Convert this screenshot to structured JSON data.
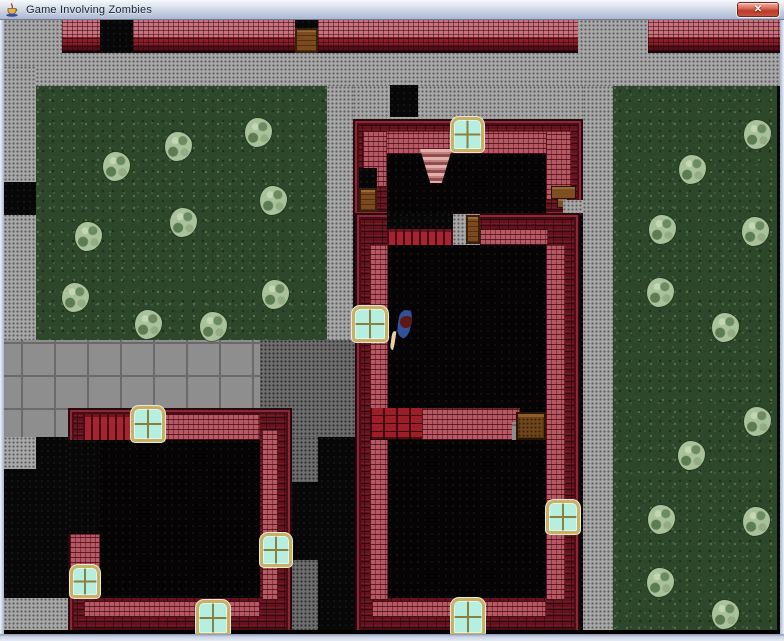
{
  "window": {
    "title": "Game Involving Zombies",
    "close_label": "✕"
  },
  "icons": {
    "app_icon": "java-coffee-cup-icon",
    "close_icon": "close-icon"
  },
  "palette": {
    "titlebar_top": "#f6f8fc",
    "titlebar_bottom": "#acb8cf",
    "frame": "#ccd4e6",
    "grass": "#2c472a",
    "bush": "#a9c29b",
    "pavement": "#a8a8a8",
    "pavement_dark": "#6e6e6e",
    "sidewalk": "#8e8e8e",
    "brick_dark": "#64121d",
    "brick_pink": "#b55a64",
    "brick_bright": "#9c1e29",
    "window_pane": "#b6efe0",
    "window_frame": "#c7b264",
    "door": "#7c4a1d",
    "chest": "#6f4519",
    "interior": "#040404",
    "player_body": "#31519b",
    "player_head": "#5e1717",
    "player_hand": "#eccfa6"
  },
  "scene": {
    "viewport": {
      "x": 4,
      "y": 20,
      "width": 776,
      "height": 614
    },
    "legend": {
      "plaza": "light dotted pavement",
      "darkplaza": "dark dotted pavement",
      "sidewalk": "gray sidewalk tiles",
      "grass": "grass lawn",
      "black": "unexplored void",
      "blackpure": "bottom black strip",
      "interior": "building interior floor",
      "wall": "dark red brick wall",
      "walltop": "street-top brick wall with pink course",
      "wallpink": "pink inner wall face",
      "redbrick": "bright red brick partition",
      "planks": "red plank wall",
      "window": "cyan window",
      "door": "wooden door",
      "chest": "wooden chest",
      "shelf": "wooden shelf",
      "stairs": "pink staircase"
    },
    "layers": [
      {
        "t": "black",
        "r": [
          0,
          0,
          776,
          614
        ]
      },
      {
        "t": "plaza",
        "r": [
          0,
          0,
          776,
          66
        ]
      },
      {
        "t": "plaza",
        "r": [
          0,
          46,
          32,
          274
        ]
      },
      {
        "t": "black",
        "r": [
          0,
          162,
          32,
          33
        ]
      },
      {
        "t": "grass",
        "r": [
          32,
          66,
          291,
          287
        ]
      },
      {
        "t": "plaza",
        "r": [
          323,
          66,
          26,
          254
        ]
      },
      {
        "t": "plaza",
        "r": [
          349,
          66,
          230,
          33
        ]
      },
      {
        "t": "plaza",
        "r": [
          579,
          66,
          30,
          548
        ]
      },
      {
        "t": "grass",
        "r": [
          609,
          66,
          164,
          544
        ]
      },
      {
        "t": "sidewalk",
        "r": [
          0,
          320,
          256,
          100
        ]
      },
      {
        "t": "darkplaza",
        "r": [
          256,
          320,
          100,
          97
        ]
      },
      {
        "t": "black",
        "r": [
          256,
          417,
          100,
          197
        ]
      },
      {
        "t": "darkplaza",
        "r": [
          288,
          417,
          26,
          45
        ]
      },
      {
        "t": "darkplaza",
        "r": [
          288,
          540,
          26,
          70
        ]
      },
      {
        "t": "black",
        "r": [
          0,
          417,
          64,
          197
        ]
      },
      {
        "t": "plaza",
        "r": [
          0,
          417,
          32,
          32
        ]
      },
      {
        "t": "plaza",
        "r": [
          0,
          578,
          64,
          34
        ]
      },
      {
        "t": "walltop",
        "r": [
          58,
          0,
          38,
          33
        ]
      },
      {
        "t": "black",
        "r": [
          96,
          0,
          33,
          33
        ]
      },
      {
        "t": "walltop",
        "r": [
          129,
          0,
          162,
          33
        ]
      },
      {
        "t": "black",
        "r": [
          291,
          0,
          23,
          10
        ]
      },
      {
        "t": "door",
        "r": [
          291,
          8,
          23,
          25
        ]
      },
      {
        "t": "walltop",
        "r": [
          314,
          0,
          260,
          33
        ]
      },
      {
        "t": "walltop",
        "r": [
          644,
          0,
          132,
          33
        ]
      },
      {
        "t": "black",
        "r": [
          386,
          65,
          28,
          32
        ]
      },
      {
        "t": "wall",
        "r": [
          349,
          99,
          230,
          97
        ]
      },
      {
        "t": "wallpink",
        "r": [
          359,
          111,
          208,
          23
        ]
      },
      {
        "t": "wallpink",
        "r": [
          359,
          111,
          24,
          56
        ]
      },
      {
        "t": "wallpink",
        "r": [
          542,
          111,
          25,
          69
        ]
      },
      {
        "t": "interior",
        "r": [
          383,
          134,
          159,
          62
        ]
      },
      {
        "t": "stairs",
        "r": [
          416,
          129,
          32,
          34
        ]
      },
      {
        "t": "black",
        "r": [
          355,
          148,
          18,
          44
        ]
      },
      {
        "t": "door",
        "r": [
          355,
          168,
          18,
          24
        ]
      },
      {
        "t": "shelf",
        "r": [
          547,
          166,
          25,
          13
        ]
      },
      {
        "t": "shelf",
        "r": [
          553,
          178,
          11,
          10
        ]
      },
      {
        "t": "plaza",
        "r": [
          559,
          180,
          20,
          13
        ]
      },
      {
        "t": "wall",
        "r": [
          351,
          193,
          225,
          421
        ]
      },
      {
        "t": "black",
        "r": [
          383,
          193,
          66,
          16
        ]
      },
      {
        "t": "planks",
        "r": [
          383,
          209,
          66,
          16
        ]
      },
      {
        "t": "plaza",
        "r": [
          449,
          194,
          27,
          31
        ]
      },
      {
        "t": "wallpink",
        "r": [
          476,
          209,
          68,
          16
        ]
      },
      {
        "t": "wallpink",
        "r": [
          366,
          225,
          18,
          355
        ]
      },
      {
        "t": "wallpink",
        "r": [
          542,
          225,
          19,
          355
        ]
      },
      {
        "t": "interior",
        "r": [
          384,
          225,
          158,
          353
        ]
      },
      {
        "t": "wallpink",
        "r": [
          368,
          581,
          174,
          16
        ]
      },
      {
        "t": "redbrick",
        "r": [
          366,
          388,
          52,
          32
        ]
      },
      {
        "t": "wallpink",
        "r": [
          418,
          388,
          98,
          32
        ]
      },
      {
        "t": "sidewalk",
        "r": [
          508,
          402,
          20,
          18
        ]
      },
      {
        "t": "chest",
        "r": [
          512,
          392,
          30,
          28
        ]
      },
      {
        "t": "door",
        "r": [
          462,
          195,
          14,
          29
        ]
      },
      {
        "t": "wall",
        "r": [
          64,
          388,
          224,
          226
        ]
      },
      {
        "t": "planks",
        "r": [
          79,
          394,
          50,
          26
        ]
      },
      {
        "t": "wallpink",
        "r": [
          159,
          394,
          97,
          26
        ]
      },
      {
        "t": "interior",
        "r": [
          96,
          420,
          160,
          158
        ]
      },
      {
        "t": "wallpink",
        "r": [
          258,
          410,
          16,
          170
        ]
      },
      {
        "t": "wallpink",
        "r": [
          80,
          581,
          176,
          16
        ]
      },
      {
        "t": "wallpink",
        "r": [
          66,
          514,
          30,
          34
        ]
      },
      {
        "t": "black",
        "r": [
          64,
          420,
          32,
          94
        ]
      },
      {
        "t": "blackpure",
        "r": [
          0,
          610,
          776,
          4
        ]
      },
      {
        "t": "window",
        "r": [
          447,
          97,
          33,
          35
        ]
      },
      {
        "t": "window",
        "r": [
          348,
          286,
          36,
          36
        ]
      },
      {
        "t": "window",
        "r": [
          542,
          480,
          34,
          34
        ]
      },
      {
        "t": "window",
        "r": [
          447,
          578,
          34,
          38
        ]
      },
      {
        "t": "window",
        "r": [
          127,
          386,
          34,
          36
        ]
      },
      {
        "t": "window",
        "r": [
          66,
          545,
          30,
          33
        ]
      },
      {
        "t": "window",
        "r": [
          256,
          513,
          32,
          34
        ]
      },
      {
        "t": "window",
        "r": [
          192,
          580,
          34,
          36
        ]
      }
    ],
    "bushes": [
      [
        99,
        132
      ],
      [
        161,
        112
      ],
      [
        241,
        98
      ],
      [
        71,
        202
      ],
      [
        166,
        188
      ],
      [
        256,
        166
      ],
      [
        58,
        263
      ],
      [
        131,
        290
      ],
      [
        196,
        292
      ],
      [
        258,
        260
      ],
      [
        740,
        100
      ],
      [
        675,
        135
      ],
      [
        645,
        195
      ],
      [
        738,
        197
      ],
      [
        643,
        258
      ],
      [
        708,
        293
      ],
      [
        740,
        387
      ],
      [
        674,
        421
      ],
      [
        644,
        485
      ],
      [
        739,
        487
      ],
      [
        643,
        548
      ],
      [
        708,
        580
      ]
    ],
    "bush_size": [
      27,
      29
    ],
    "player": {
      "x": 387,
      "y": 286,
      "w": 22,
      "h": 36
    }
  }
}
